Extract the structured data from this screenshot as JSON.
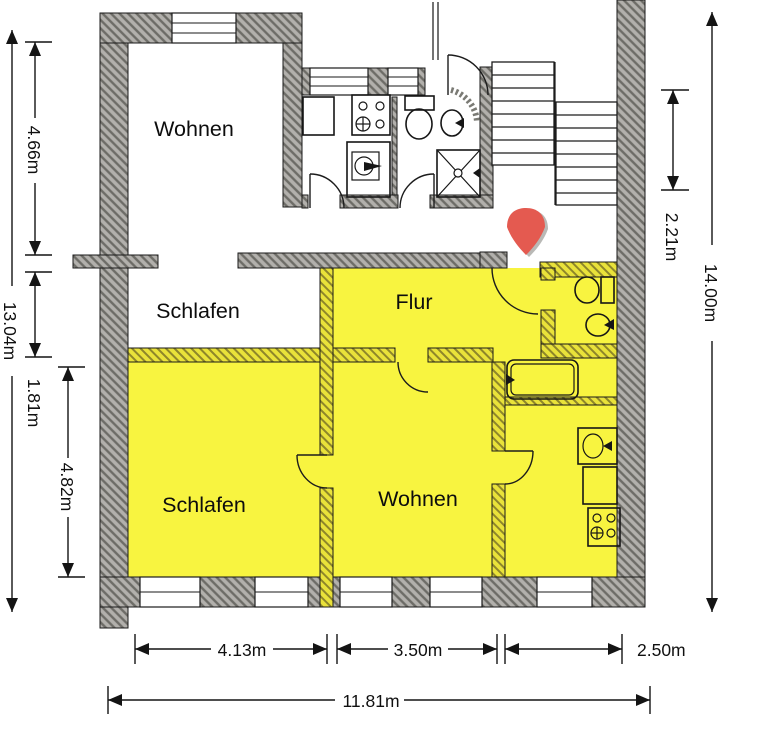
{
  "document": {
    "kind": "apartment-floor-plan"
  },
  "colors": {
    "highlight": "#f8f440",
    "highlight_wall": "#e9e23a",
    "highlight_wall_hatch": "#8e862a",
    "wall_gray": "#b2b0ac",
    "wall_gray_hatch": "#6d6c67",
    "ink": "#1a1a1a",
    "entrance_arrow": "#e45a50",
    "entrance_arrow_shadow": "#b9b9b6"
  },
  "rooms": [
    {
      "id": "wohnen-top",
      "label": "Wohnen",
      "highlighted": false
    },
    {
      "id": "schlafen-middle",
      "label": "Schlafen",
      "highlighted": false
    },
    {
      "id": "flur",
      "label": "Flur",
      "highlighted": true
    },
    {
      "id": "schlafen-bottom",
      "label": "Schlafen",
      "highlighted": true
    },
    {
      "id": "wohnen-bottom",
      "label": "Wohnen",
      "highlighted": true
    }
  ],
  "dimensions": {
    "left_upper": "4.66m",
    "left_middle": "1.81m",
    "left_lower": "4.82m",
    "left_total": "13.04m",
    "right_stairs": "2.21m",
    "right_total": "14.00m",
    "bottom_left": "4.13m",
    "bottom_middle": "3.50m",
    "bottom_right": "2.50m",
    "bottom_total": "11.81m"
  },
  "icons": [
    "stove-icon",
    "kitchen-sink-icon",
    "toilet-icon",
    "hand-basin-icon",
    "shower-icon",
    "bathtub-icon",
    "stairs-icon",
    "entrance-arrow-icon",
    "door-swing-icon"
  ]
}
